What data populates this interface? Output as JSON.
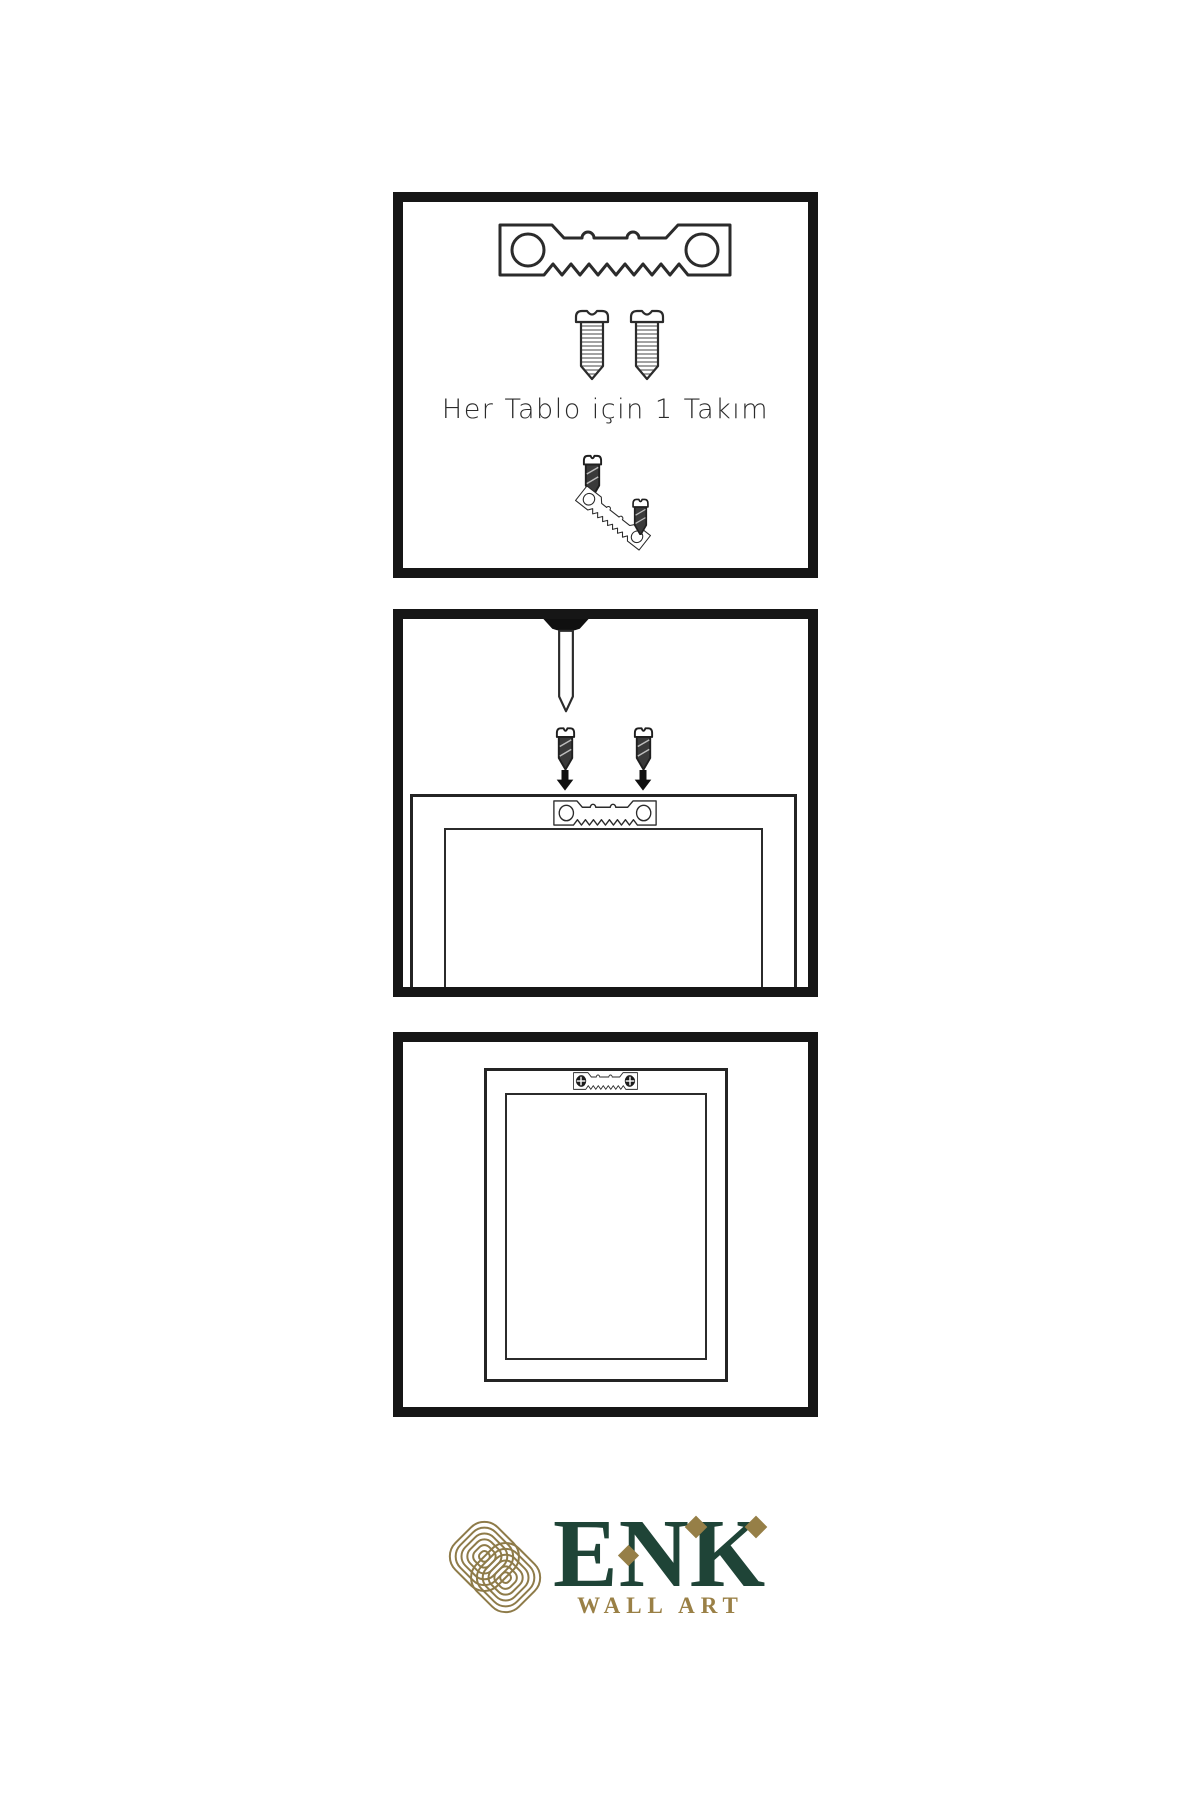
{
  "page": {
    "background": "#ffffff",
    "type": "wall-art hanging instruction sheet"
  },
  "panels": [
    {
      "name": "hardware-kit",
      "caption": "Her Tablo için 1 Takım",
      "icons": [
        "sawtooth-hanger-icon",
        "screw-icon",
        "screw-icon",
        "dark-screw-icon",
        "tilted-sawtooth-hanger-icon",
        "dark-screw-icon"
      ]
    },
    {
      "name": "attach-hanger-to-frame",
      "icons": [
        "wall-nail-icon",
        "dark-screw-icon",
        "dark-screw-icon",
        "arrow-down-icon",
        "arrow-down-icon",
        "frame-back-icon",
        "sawtooth-hanger-icon"
      ]
    },
    {
      "name": "hang-frame-on-wall",
      "icons": [
        "frame-front-icon",
        "sawtooth-hanger-icon",
        "phillips-screw-head-icon",
        "phillips-screw-head-icon"
      ]
    }
  ],
  "logo": {
    "brand": "ENK",
    "subtitle": "WALL ART",
    "symbol": "interlaced-knot-icon",
    "colors": {
      "green": "#1f4437",
      "gold": "#967f47"
    }
  },
  "colors": {
    "panel_border": "#161616",
    "line_art": "#2b2b2b",
    "screw_dark_fill": "#3a3a3a"
  }
}
